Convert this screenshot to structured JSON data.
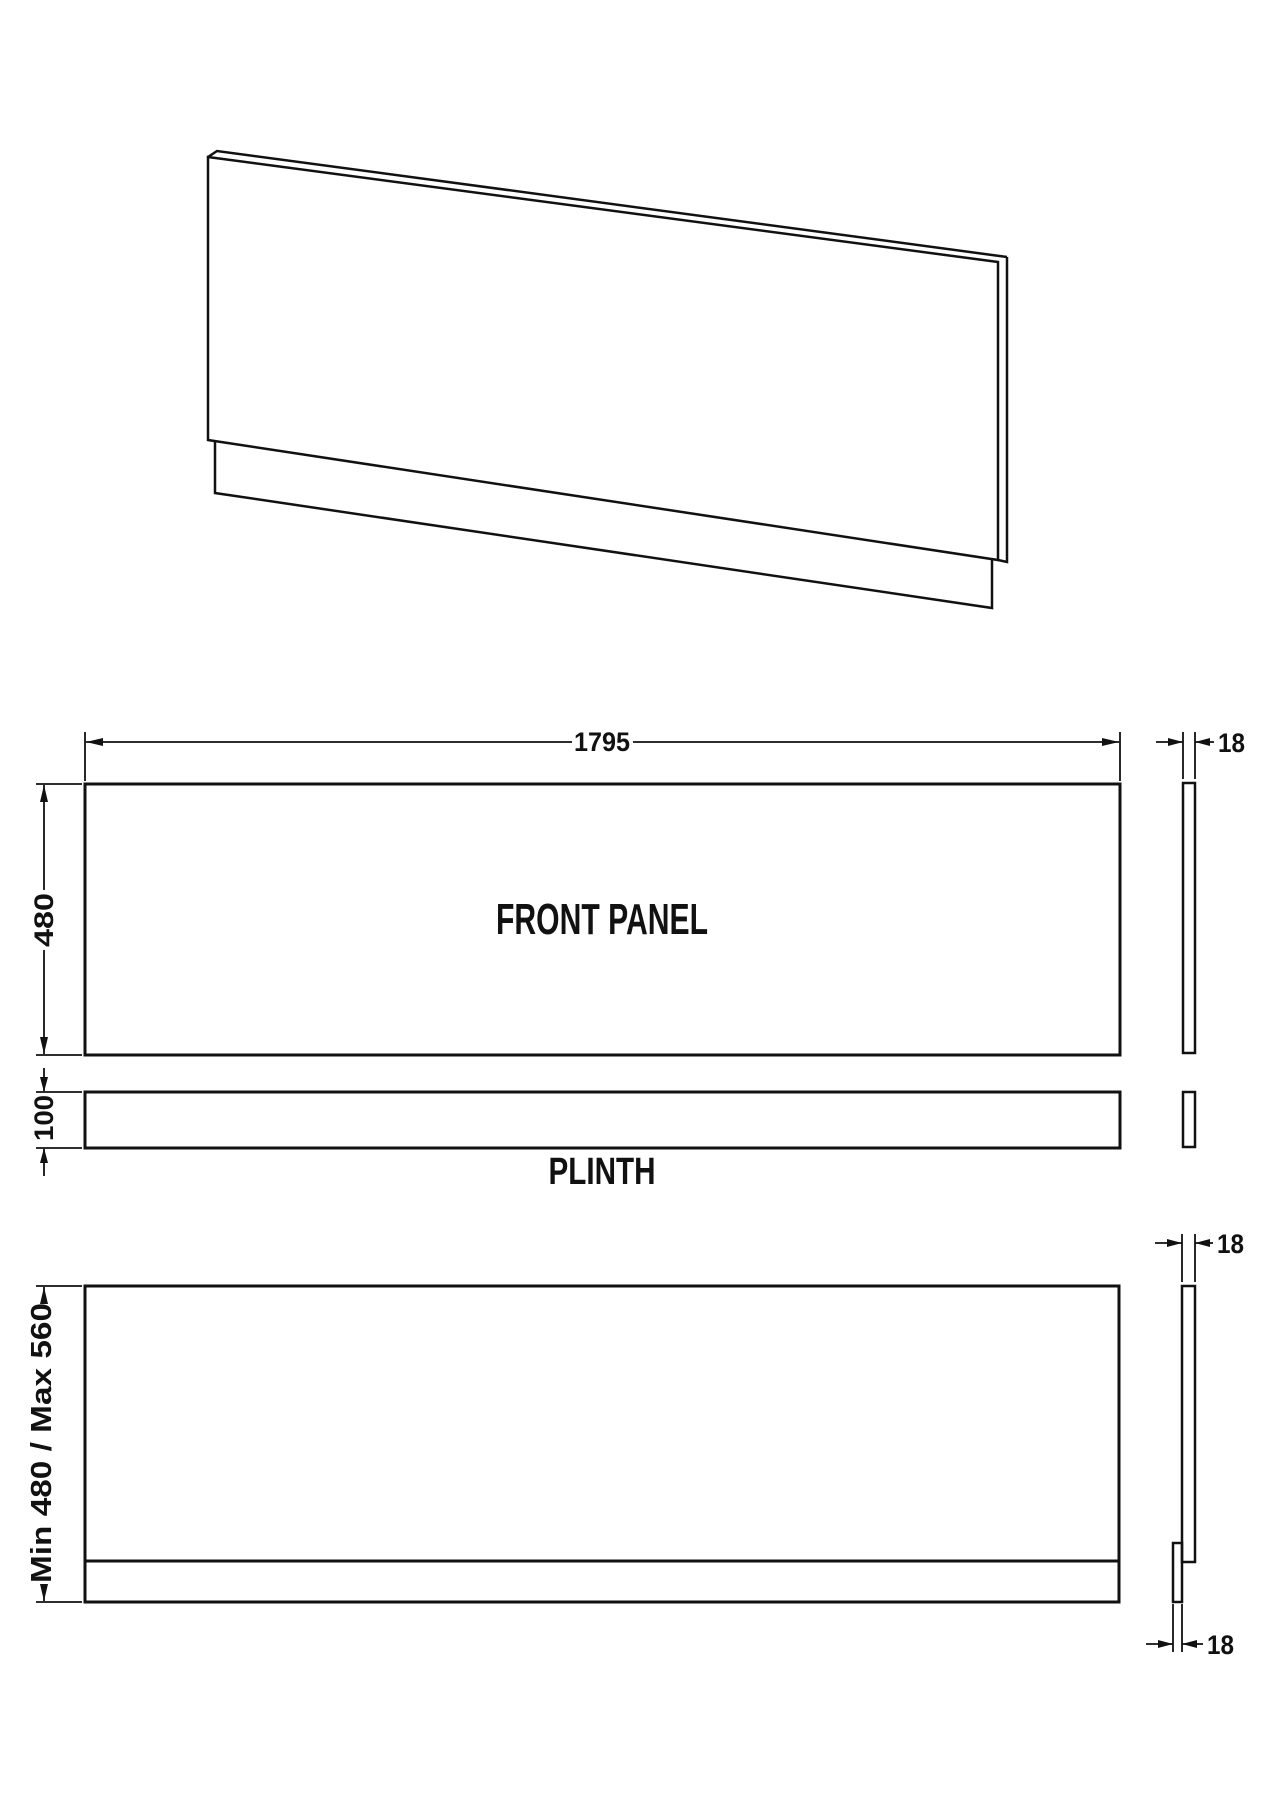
{
  "front_view": {
    "label": "FRONT PANEL",
    "width_dim": "1795",
    "height_dim": "480",
    "thickness_dim": "18"
  },
  "plinth_view": {
    "label": "PLINTH",
    "height_dim": "100"
  },
  "adjustable_view": {
    "height_range_dim": "Min 480 / Max 560",
    "panel_thickness_dim": "18",
    "plinth_thickness_dim": "18"
  },
  "colors": {
    "line": "#111111",
    "background": "#ffffff"
  }
}
